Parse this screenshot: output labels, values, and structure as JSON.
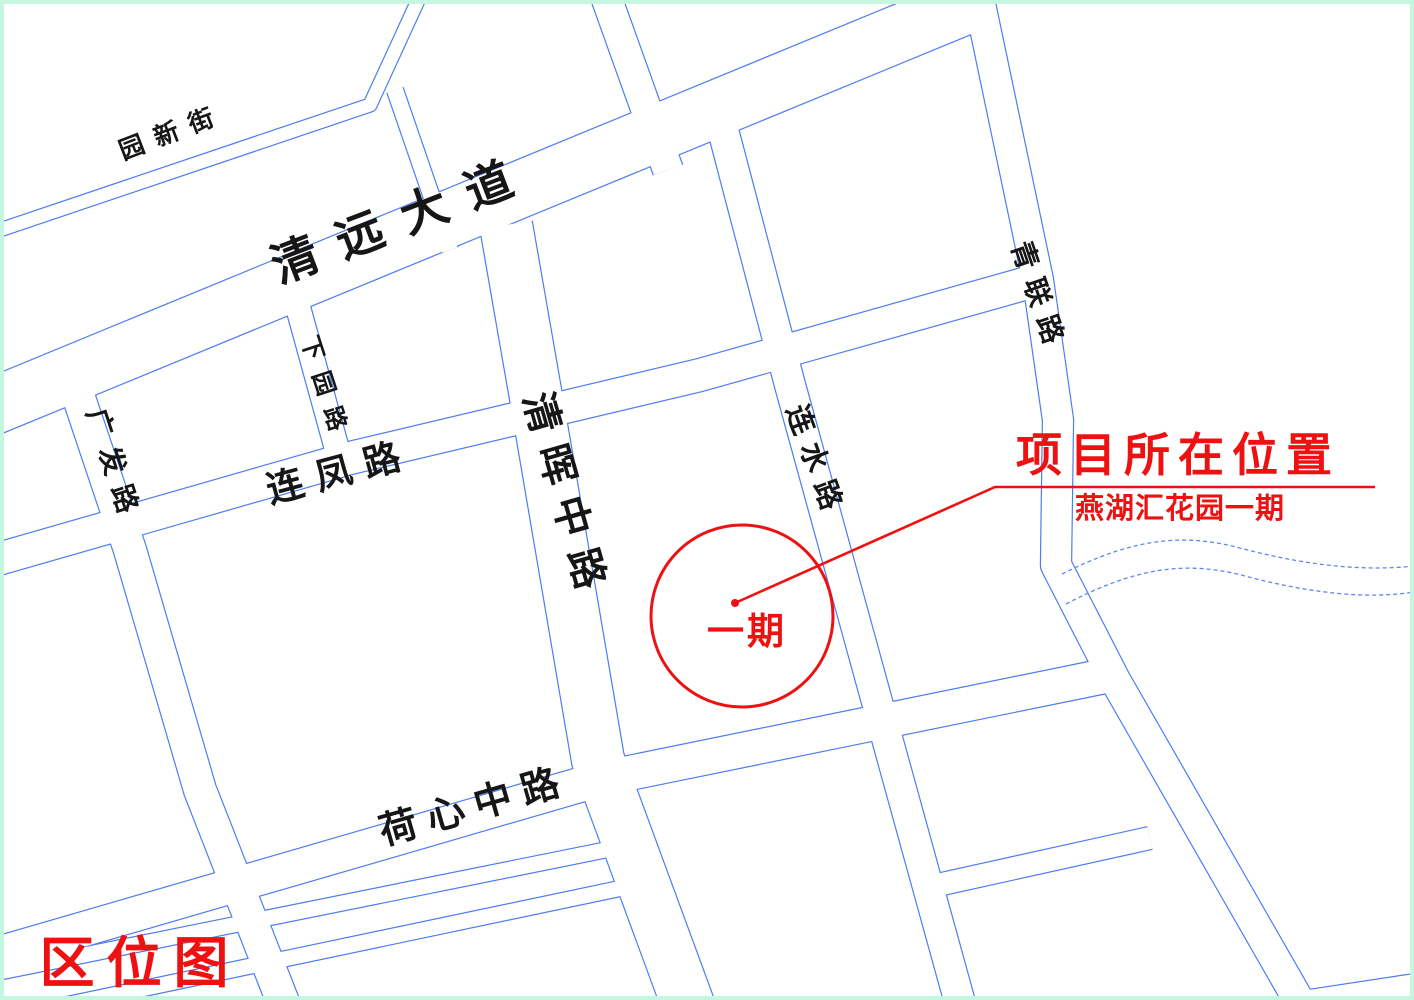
{
  "map_title": "区位图",
  "roads": {
    "yuanxinjie": "园新街",
    "qingyuan_avenue": "清远大道",
    "xiayuan_road": "下园路",
    "lianfeng_road": "连凤路",
    "qinghui_middle_road": "清晖中路",
    "lianshui_road": "连水路",
    "qinglian_road": "青联路",
    "guangfa_road": "广发路",
    "hexin_middle_road": "荷心中路"
  },
  "annotation": {
    "title": "项目所在位置",
    "subtitle": "燕湖汇花园一期",
    "phase_label": "一期"
  },
  "colors": {
    "road_line": "#4d7cf3",
    "river_line": "#5d87f2",
    "annotation_red": "#ee1111",
    "label_black": "#161616",
    "border_mint": "#c4f6e0",
    "background": "#ffffff"
  }
}
